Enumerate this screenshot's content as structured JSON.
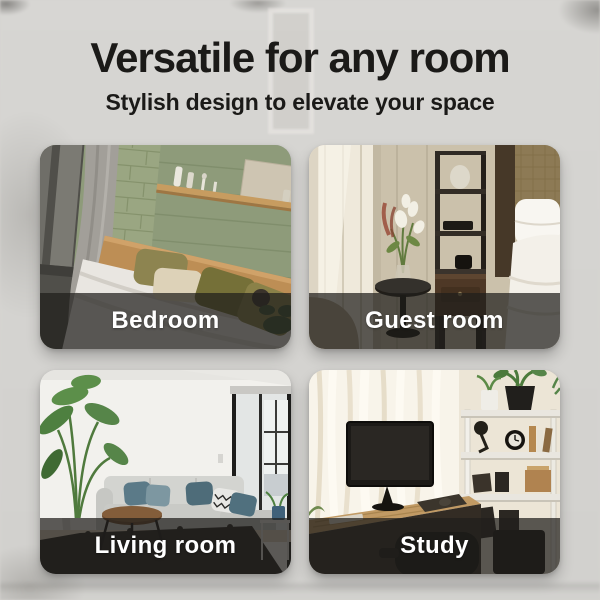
{
  "header": {
    "title": "Versatile for any room",
    "subtitle": "Stylish design to elevate your space"
  },
  "rooms": [
    {
      "label": "Bedroom"
    },
    {
      "label": "Guest room"
    },
    {
      "label": "Living room"
    },
    {
      "label": "Study"
    }
  ],
  "style": {
    "background_color": "#d5d3d0",
    "heading_color": "#1b1a18",
    "label_band_color": "rgba(32,30,28,0.72)",
    "label_text_color": "#ffffff"
  }
}
